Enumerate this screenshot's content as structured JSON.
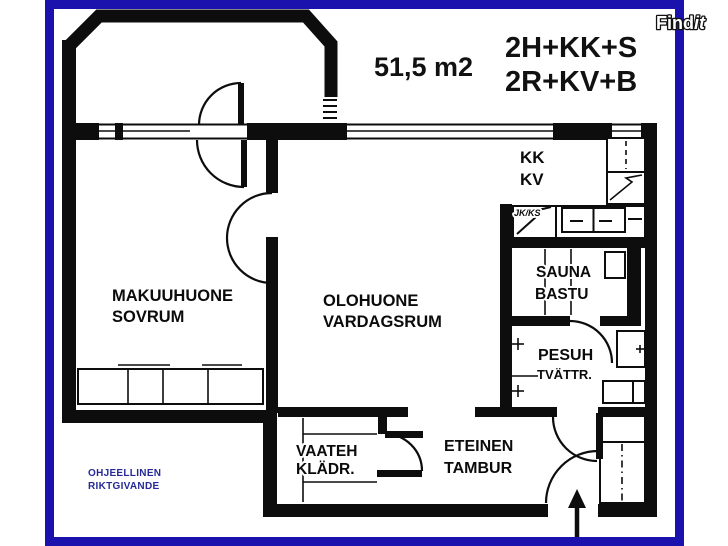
{
  "header": {
    "area_label": "51,5 m2",
    "apartment_type_fi": "2H+KK+S",
    "apartment_type_sv": "2R+KV+B"
  },
  "watermark": {
    "brand_main": "Find",
    "brand_suffix": "it"
  },
  "rooms": {
    "bedroom": {
      "fi": "MAKUUHUONE",
      "sv": "SOVRUM"
    },
    "living": {
      "fi": "OLOHUONE",
      "sv": "VARDAGSRUM"
    },
    "kitchen": {
      "fi": "KK",
      "sv": "KV"
    },
    "sauna": {
      "fi": "SAUNA",
      "sv": "BASTU"
    },
    "washroom": {
      "fi": "PESUH",
      "sv": "TVÄTTR."
    },
    "closet": {
      "fi": "VAATEH",
      "sv": "KLÄDR."
    },
    "hall": {
      "fi": "ETEINEN",
      "sv": "TAMBUR"
    }
  },
  "fixtures": {
    "fridge_freezer_label": "JK/KS"
  },
  "footnote": {
    "fi": "OHJEELLINEN",
    "sv": "RIKTGIVANDE"
  },
  "colors": {
    "frame_blue": "#1b12ae",
    "wall_black": "#0d0d0d",
    "footnote_blue": "#262a97"
  }
}
